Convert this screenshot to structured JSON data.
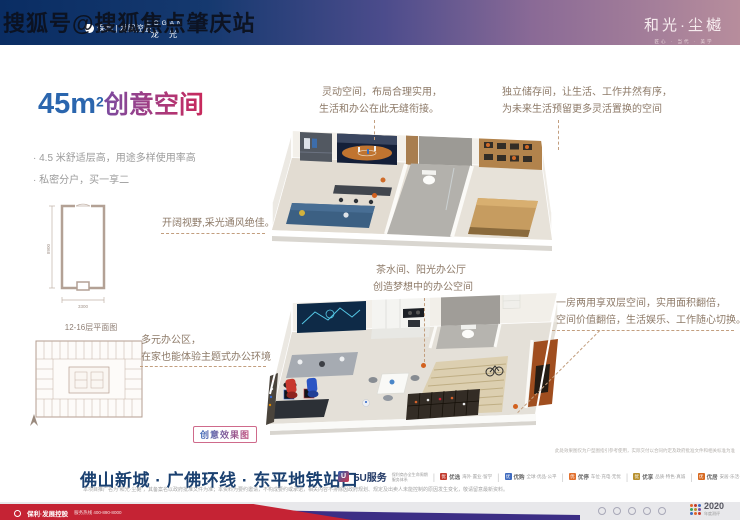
{
  "watermark": "搜狐号@搜狐焦点肇庆站",
  "top_bar": {
    "poly_logo": "保利 | 发展控股",
    "logan_en": "LOGAN",
    "logan_cn": "龙 光",
    "brand": "和光·尘樾",
    "brand_tagline": "匠心 · 当代 · 美学"
  },
  "hero": {
    "title_number": "45m",
    "title_sup": "2",
    "title_text": "创意空间",
    "bullet_1": "· 4.5 米舒适层高，用途多样使用率高",
    "bullet_2": "· 私密分户，买一享二"
  },
  "floorplan": {
    "dim_height": "8900",
    "dim_width": "3300",
    "plate_label": "12-16层平面图"
  },
  "annotations": {
    "flex_1": "灵动空间，布局合理实用，",
    "flex_2": "生活和办公在此无缝衔接。",
    "store_1": "独立储存间，让生活、工作井然有序，",
    "store_2": "为未来生活预留更多灵活置换的空间",
    "view": "开阔视野,采光通风绝佳。",
    "tea_1": "茶水间、阳光办公厅",
    "tea_2": "创造梦想中的办公空间",
    "dual_1": "一房两用享双层空间，实用面积翻倍，",
    "dual_2": "空间价值翻倍，生活娱乐、工作随心切换。",
    "office_1": "多元办公区，",
    "office_2": "在家也能体验主题式办公环境"
  },
  "badge_label": "创意效果图",
  "render_note": "此处效果图仅为户型图指引参考使用，实际交付以合同约定及政府批准文件和相关标准为准",
  "footer": {
    "headline": "佛山新城 · 广佛环线 · 东平地铁站口",
    "disclaimer": "本项目推广名为“和光·尘樾”，其备案名以政府批准文件为准；本资料为要约邀请，不构成要约或承诺，相关内容不排除因政府规划、规定及出卖人未能控制的原因发生变化，敬请留意最新资料。",
    "service_brand": "5U服务",
    "service_sub_1": "保利商办全生命周期",
    "service_sub_2": "服务体系",
    "services": [
      {
        "icon": "优",
        "tag": "优选",
        "desc": "海外·置业·留学"
      },
      {
        "icon": "优",
        "tag": "优购",
        "desc": "全球·优品·公平"
      },
      {
        "icon": "优",
        "tag": "优停",
        "desc": "车位·充电·无忧"
      },
      {
        "icon": "优",
        "tag": "优享",
        "desc": "品质·特色·真诚"
      },
      {
        "icon": "优",
        "tag": "优居",
        "desc": "安居·乐活·多维"
      }
    ],
    "hotline_brand": "保利·发展控股",
    "hotline": "服务热线 400-890-8000",
    "award_year": "2020",
    "award_sub": "年度测评"
  }
}
